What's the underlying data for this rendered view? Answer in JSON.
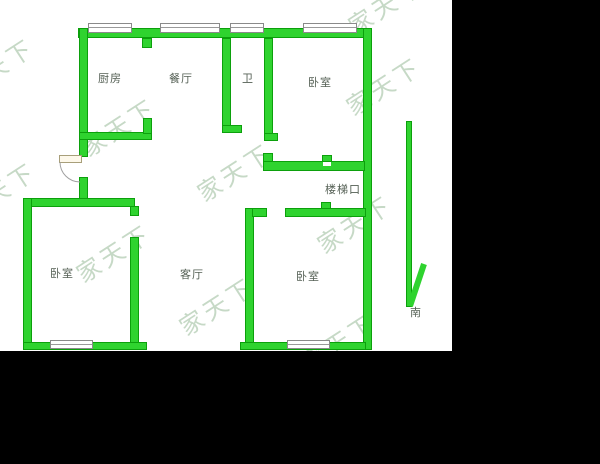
{
  "floorplan": {
    "watermark_text": "家天下",
    "rooms": [
      {
        "id": "kitchen",
        "label": "厨房"
      },
      {
        "id": "dining-room",
        "label": "餐厅"
      },
      {
        "id": "bathroom",
        "label": "卫"
      },
      {
        "id": "bedroom-northeast",
        "label": "卧室"
      },
      {
        "id": "stair-landing",
        "label": "楼梯口"
      },
      {
        "id": "bedroom-southwest",
        "label": "卧室"
      },
      {
        "id": "living-room",
        "label": "客厅"
      },
      {
        "id": "bedroom-south",
        "label": "卧室"
      }
    ],
    "compass": {
      "direction_label": "南"
    },
    "colors": {
      "wall": "#2fd32f",
      "wall_border": "#0ca00c",
      "label_text": "#556055",
      "watermark": "#c6d9c6"
    }
  }
}
